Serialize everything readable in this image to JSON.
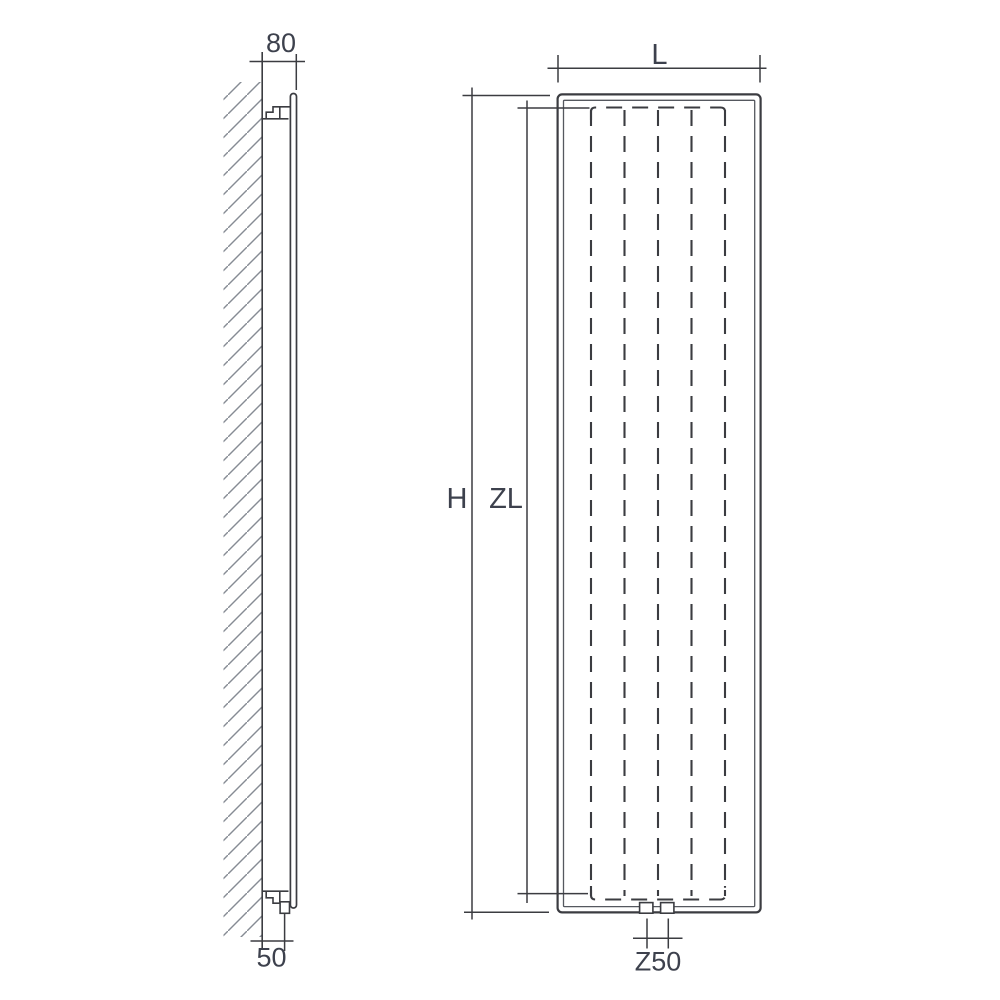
{
  "colors": {
    "line": "#3b3c41",
    "innerline": "#55585f",
    "text": "#3d414d",
    "hatch": "#868b94",
    "background": "#ffffff"
  },
  "side_view": {
    "wall_offset_label": "80",
    "pipe_offset_label": "50"
  },
  "front_view": {
    "width_label": "L",
    "height_label": "H",
    "element_height_label": "ZL",
    "connection_spacing_label": "Z50",
    "element_columns": 5,
    "connection_ports": 2
  }
}
